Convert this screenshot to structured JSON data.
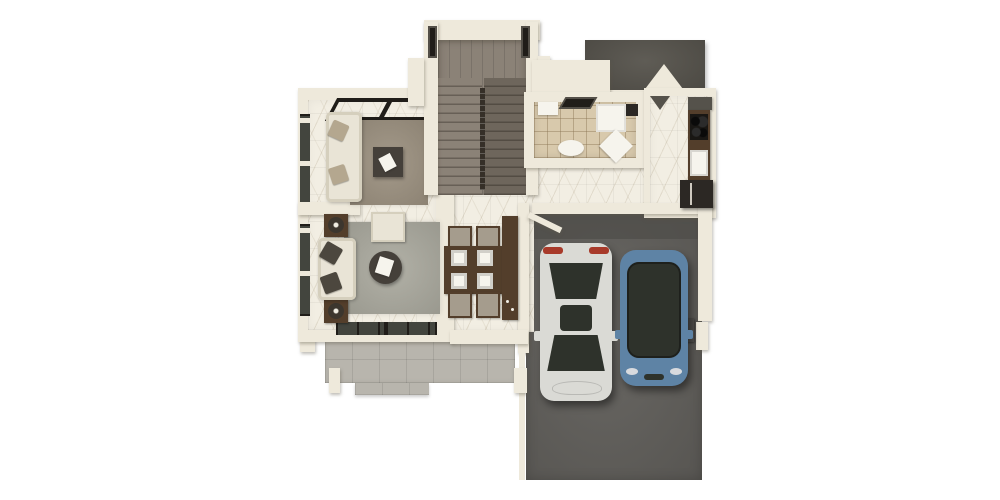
{
  "scene": {
    "kind": "3d-rendered-floor-plan",
    "description": "Top-down 3D architectural render of a house ground floor: two lounge areas with sofas on the left, a U-shaped wooden staircase at top, a tiled bathroom and a kitchen at top right under a dark roof section, a dining table with four chairs in the central hall, a rear grey-tiled patio, and a dark concrete driveway on the right with a white car and a blue car parked side by side.",
    "background": "#ffffff"
  },
  "canvas": {
    "width": 1000,
    "height": 500
  },
  "palette": {
    "bg": "#ffffff",
    "wall": "#eee9db",
    "marble": "#f2eee3",
    "tile-bath": "#d8c9ac",
    "patio": "#b8b5ad",
    "concrete": "#615f5b",
    "concrete-dark": "#4f4d4a",
    "stair-wood": "#8b8277",
    "stair-dark": "#6e665c",
    "rail": "#352f28",
    "roof": "#55524b",
    "frame": "#201d19",
    "glass": "#43453e",
    "sofa": "#e9e4d6",
    "cushion": "#d5cfbd",
    "pillow-dark": "#4c473e",
    "pillow-taupe": "#b4a78f",
    "rug-taupe": "#9c9180",
    "rug-gray": "#abaa9f",
    "table-dark": "#45403a",
    "wood": "#533e2b",
    "chair": "#a59c8d",
    "plate": "#f6f4ed",
    "fridge": "#2c2824",
    "lamp": "#3c362e",
    "car-white": "#dadad5",
    "car-blue": "#5e83a5",
    "car-glass": "#2e322b",
    "taillight": "#a83a2a"
  },
  "rooms": [
    {
      "name": "lounge-upper",
      "floor": "marble",
      "features": [
        "cream sofa",
        "taupe rug",
        "square coffee table",
        "skylight frames",
        "side windows"
      ]
    },
    {
      "name": "lounge-lower",
      "floor": "marble",
      "features": [
        "beige sofa",
        "grey rug",
        "round coffee table",
        "armchair",
        "two lamp side tables"
      ]
    },
    {
      "name": "staircase",
      "material": "grey-brown wood",
      "shape": "U-shaped with centre railing"
    },
    {
      "name": "bathroom",
      "floor": "beige tile",
      "features": [
        "toilet",
        "vanity",
        "shower",
        "ceiling vent"
      ]
    },
    {
      "name": "kitchen",
      "floor": "marble",
      "features": [
        "dark wood counter",
        "cooktop",
        "sink",
        "refrigerator",
        "range hood"
      ]
    },
    {
      "name": "dining-hall",
      "floor": "marble",
      "features": [
        "wooden table",
        "four chairs",
        "four place settings",
        "tall sideboard"
      ]
    },
    {
      "name": "patio",
      "floor": "grey tile",
      "features": [
        "step",
        "white posts"
      ]
    },
    {
      "name": "driveway-garage",
      "floor": "dark concrete",
      "features": [
        "open gate door",
        "boundary walls",
        "gate post"
      ]
    }
  ],
  "vehicles": [
    {
      "name": "white-car",
      "body_color": "#dadad5",
      "detail": "red tail lights, dark glazing, sunroof",
      "position": "left bay, rear facing up"
    },
    {
      "name": "blue-car",
      "body_color": "#5e83a5",
      "detail": "full dark glass canopy, silver headlights",
      "position": "right bay, rear facing up"
    }
  ],
  "roof_section": {
    "name": "garage-roof",
    "color": "#55524b",
    "feature": "white gable triangle notch"
  }
}
